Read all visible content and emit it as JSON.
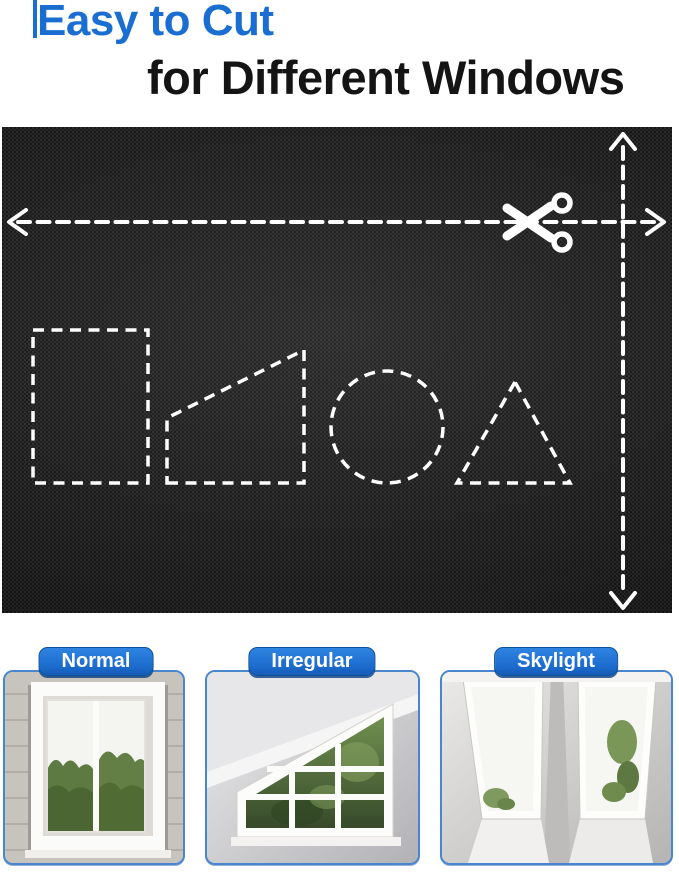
{
  "page": {
    "type": "product-infographic"
  },
  "title": {
    "line1": "Easy to Cut",
    "line2": "for Different Windows"
  },
  "fabric_panel": {
    "description": "black blackout fabric with dashed cutting guides",
    "cut_shapes": [
      "rectangle",
      "trapezoid",
      "circle",
      "triangle"
    ],
    "icons": [
      "scissors-icon",
      "arrow-left-icon",
      "arrow-right-icon",
      "arrow-up-icon",
      "arrow-down-icon"
    ]
  },
  "window_cards": [
    {
      "label": "Normal"
    },
    {
      "label": "Irregular"
    },
    {
      "label": "Skylight"
    }
  ],
  "colors": {
    "title_blue": "#1a6ed2",
    "title_dark": "#141414",
    "pill_blue": "#1e72d4",
    "pill_border": "#0f4f9e",
    "card_border": "#4a86cf",
    "fabric_dark": "#242424",
    "dash_white": "#ffffff"
  }
}
